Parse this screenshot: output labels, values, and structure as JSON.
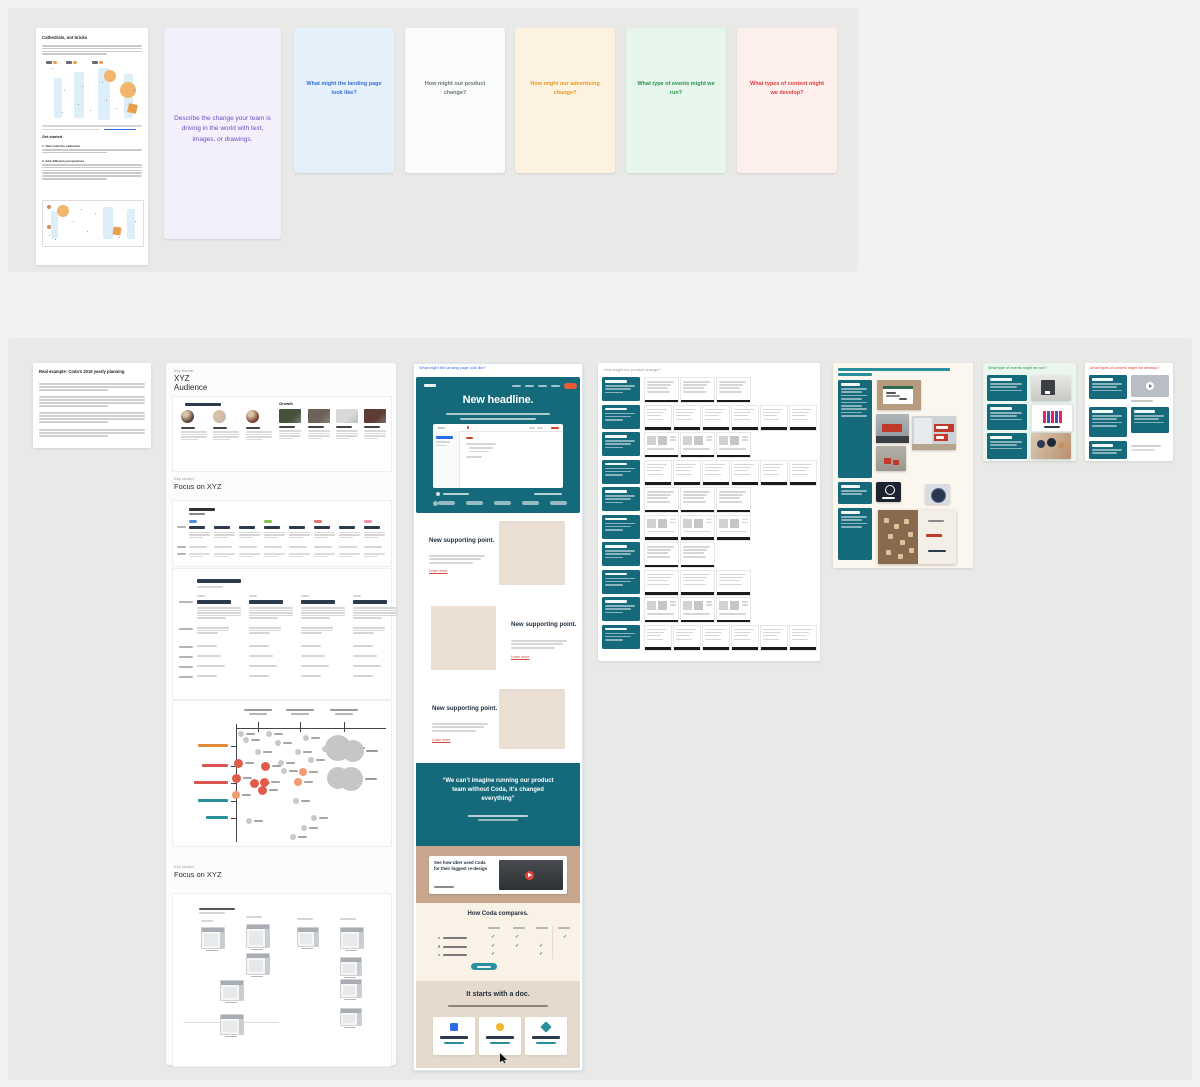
{
  "page": {
    "canvas_bg": "#f1f1ef",
    "band_bg": "#e9e9e7"
  },
  "colors": {
    "teal": "#14697a",
    "teal_link": "#2a8f9c",
    "blue": "#3a6fd8",
    "orange_btn": "#ee5b35",
    "red_link": "#cf4a3f",
    "navy": "#22303f",
    "beige_img": "#eadfd2",
    "tan_band": "#c8a78e",
    "cream_band": "#fbf2e7",
    "footer_band": "#e5dacb",
    "skeleton": "#d6d6d6",
    "bubble_gray": "#c9c9c9",
    "bubble_red": "#e05c4a",
    "bubble_orange": "#f09b72"
  },
  "intro_doc": {
    "title": "Cathedrals, not bricks",
    "get_started": "Get started",
    "step1": "1. Start with the cathedral",
    "step2": "2. Add different perspectives"
  },
  "prompt_card": {
    "text": "Describe the change your team is driving in the world with text, images, or drawings."
  },
  "questions": [
    {
      "text": "What might the landing page look like?",
      "bg": "#e4f1fa",
      "color": "#3a6fd8"
    },
    {
      "text": "How might our product change?",
      "bg": "#fafbfb",
      "color": "#70757a"
    },
    {
      "text": "How might our advertising change?",
      "bg": "#fdf1df",
      "color": "#e89a1c"
    },
    {
      "text": "What type of events might we run?",
      "bg": "#e7f6ec",
      "color": "#27934c"
    },
    {
      "text": "What types of content might we develop?",
      "bg": "#fdefeb",
      "color": "#e23d3d"
    }
  ],
  "example_note": {
    "title": "Real example: Coda's 2019 yearly planning"
  },
  "column": {
    "theme_label": "Key theme:",
    "theme_title_line1": "XYZ",
    "theme_title_line2": "Audience",
    "growth_label": "Growth",
    "choice_label": "Key choice:",
    "choice_title": "Focus on XYZ",
    "choice2_label": "Key choice:",
    "choice2_title": "Focus on XYZ"
  },
  "landing": {
    "link": "What might the landing page look like?",
    "headline": "New headline.",
    "supporting_title": "New supporting point.",
    "learn_more": "Learn more",
    "quote": "“We can’t imagine running our product team without Coda, it’s changed everything”",
    "video_title": "See how Uber used Coda for their biggest re-design",
    "compare_title": "How Coda compares.",
    "footer_title": "It starts with a doc."
  },
  "ad_grid": {
    "rows": [
      {
        "cards": 3,
        "style": "lines"
      },
      {
        "cards": 6,
        "style": "lines"
      },
      {
        "cards": 3,
        "style": "thumbs"
      },
      {
        "cards": 6,
        "style": "lines"
      },
      {
        "cards": 3,
        "style": "lines"
      },
      {
        "cards": 3,
        "style": "thumbs"
      },
      {
        "cards": 2,
        "style": "lines"
      },
      {
        "cards": 3,
        "style": "lines"
      },
      {
        "cards": 3,
        "style": "thumbs"
      },
      {
        "cards": 6,
        "style": "lines"
      }
    ]
  },
  "bubble_chart": {
    "type": "scatter",
    "column_ticks_x": [
      85,
      127,
      171
    ],
    "row_labels": [
      {
        "y": 45,
        "color": "#e08a3c",
        "w": 30
      },
      {
        "y": 65,
        "color": "#d9534f",
        "w": 26
      },
      {
        "y": 82,
        "color": "#d9534f",
        "w": 34
      },
      {
        "y": 100,
        "color": "#2a8f9c",
        "w": 30
      },
      {
        "y": 117,
        "color": "#2a8f9c",
        "w": 22
      }
    ],
    "gray": [
      [
        68,
        33
      ],
      [
        96,
        33
      ],
      [
        73,
        39
      ],
      [
        105,
        42
      ],
      [
        85,
        51
      ],
      [
        125,
        51
      ],
      [
        133,
        37
      ],
      [
        108,
        62
      ],
      [
        111,
        70
      ],
      [
        138,
        59
      ],
      [
        152,
        48
      ],
      [
        123,
        100
      ],
      [
        76,
        120
      ],
      [
        141,
        117
      ],
      [
        131,
        127
      ],
      [
        120,
        136
      ]
    ],
    "red": [
      [
        65,
        62
      ],
      [
        92,
        65
      ],
      [
        63,
        77
      ],
      [
        81,
        82
      ],
      [
        91,
        81
      ],
      [
        89,
        89
      ]
    ],
    "orange": [
      [
        130,
        71
      ],
      [
        125,
        81
      ],
      [
        63,
        94
      ]
    ],
    "big": [
      [
        165,
        47,
        13
      ],
      [
        180,
        50,
        11
      ],
      [
        165,
        77,
        11
      ],
      [
        178,
        78,
        12
      ]
    ]
  },
  "org_windows": [
    [
      28,
      33,
      22,
      20
    ],
    [
      73,
      30,
      22,
      22
    ],
    [
      73,
      59,
      22,
      20
    ],
    [
      124,
      33,
      20,
      18
    ],
    [
      167,
      33,
      22,
      20
    ],
    [
      167,
      63,
      20,
      17
    ],
    [
      47,
      86,
      22,
      19
    ],
    [
      167,
      85,
      20,
      17
    ],
    [
      47,
      120,
      22,
      19
    ],
    [
      167,
      114,
      20,
      16
    ]
  ],
  "compare_checks": [
    [
      1,
      1,
      0,
      1
    ],
    [
      1,
      1,
      1,
      0
    ],
    [
      1,
      0,
      1,
      0
    ]
  ],
  "table_chips": [
    "#4a90d9",
    null,
    null,
    "#8bc34a",
    null,
    "#e57373",
    null,
    "#f48fb1"
  ]
}
